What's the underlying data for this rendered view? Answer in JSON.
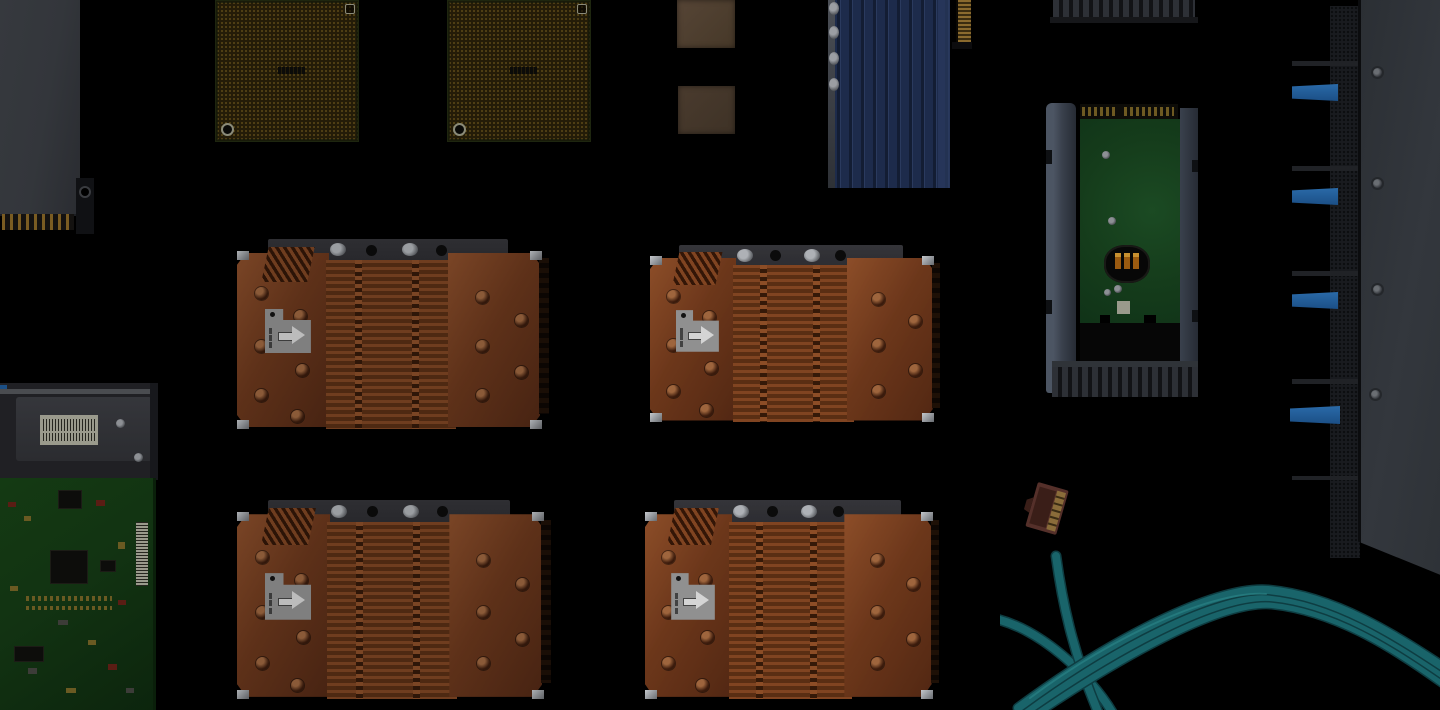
{
  "scene": {
    "title": "server-hardware-flatlay",
    "description": "Very dark flat-lay photograph of server hardware components on black",
    "background": "#000000",
    "components": [
      {
        "name": "memory-module",
        "kind": "DIMM heat-spreader slab with gold edge pins"
      },
      {
        "name": "cpu-chip-left",
        "kind": "gold land-grid processor package"
      },
      {
        "name": "cpu-chip-right",
        "kind": "gold land-grid processor package"
      },
      {
        "name": "thermal-pad-top",
        "kind": "tan ceramic pad"
      },
      {
        "name": "thermal-pad-bottom",
        "kind": "tan ceramic pad"
      },
      {
        "name": "blue-finned-heatsink",
        "kind": "navy extruded heatsink with vertical fins"
      },
      {
        "name": "gold-card-edge",
        "kind": "gold connector finger strip"
      },
      {
        "name": "latch-teeth-strip",
        "kind": "caddy latch teeth at top edge"
      },
      {
        "name": "drive-caddy",
        "kind": "2.5-inch drive in gray tray, green PCB, SATA fingers, latch teeth"
      },
      {
        "name": "copper-heatsink-1",
        "kind": "copper finned heatsink, airflow arrow label"
      },
      {
        "name": "copper-heatsink-2",
        "kind": "copper finned heatsink, airflow arrow label"
      },
      {
        "name": "copper-heatsink-3",
        "kind": "copper finned heatsink, airflow arrow label"
      },
      {
        "name": "copper-heatsink-4",
        "kind": "copper finned heatsink, airflow arrow label"
      },
      {
        "name": "chassis-panel",
        "kind": "server chassis edge with mesh drive bays and blue latch tabs"
      },
      {
        "name": "metal-enclosure",
        "kind": "bracket with white barcode label"
      },
      {
        "name": "controller-board",
        "kind": "green PCB with black chips and barcode labels"
      },
      {
        "name": "ethernet-cable",
        "kind": "teal network cable bundle with RJ45 plug"
      }
    ],
    "colors": {
      "bg": "#000000",
      "gold_pins": "#7a5c22",
      "gold_chip": "#5a4718",
      "gold_chip_dark": "#241c08",
      "chip_edge": "#1e260f",
      "corner_mark": "#8a8a78",
      "tan1": "#564536",
      "tan2": "#4a3b2e",
      "navy": "#1d2b4b",
      "navy_dark": "#131d33",
      "navy_hi": "#2a3a5e",
      "gold_conn": "#8a6a2e",
      "gold_conn_dark": "#3a2c10",
      "teeth": "#2d3036",
      "teeth_dark": "#121316",
      "sata_gold": "#6e5a22",
      "pcb_green": "#153c1b",
      "motor_orange": "#9a5a10",
      "motor_gold": "#c89030",
      "label_white": "#9a9a8c",
      "barcode": "#26261f",
      "screw_silver": "#8d9095",
      "mesh": "#191b1f",
      "mesh_dot": "#0c0d0f",
      "railbar": "#202226",
      "blue_tab": "#2a6aa8",
      "blue_tab_dark": "#1b4f86",
      "chassis_edge": "#0b0c0e",
      "copper": "#5e3119",
      "copper_hi": "#7a4526",
      "fin_a": "#4e2912",
      "fin_b": "#6f3d1f",
      "copper_dark": "#2e1608",
      "bracket": "#26262a",
      "standoff": "#9a9da1",
      "hole": "#0a0a0a",
      "hslabel": "#7f7f7f",
      "hslabel_arrow": "#bcbcbc",
      "encl_rail": "#4a4c50",
      "pcb2": "#123312",
      "pcb2_dark": "#0c250d",
      "chip_black": "#0d0d0b",
      "teal": "#19646a",
      "teal_dark": "#0e3d42",
      "teal_hi": "#2f8d8f",
      "rj45_body": "#55302a",
      "rj45_dark": "#3a1e18",
      "rj45_pins": "#8a6c3a"
    }
  }
}
